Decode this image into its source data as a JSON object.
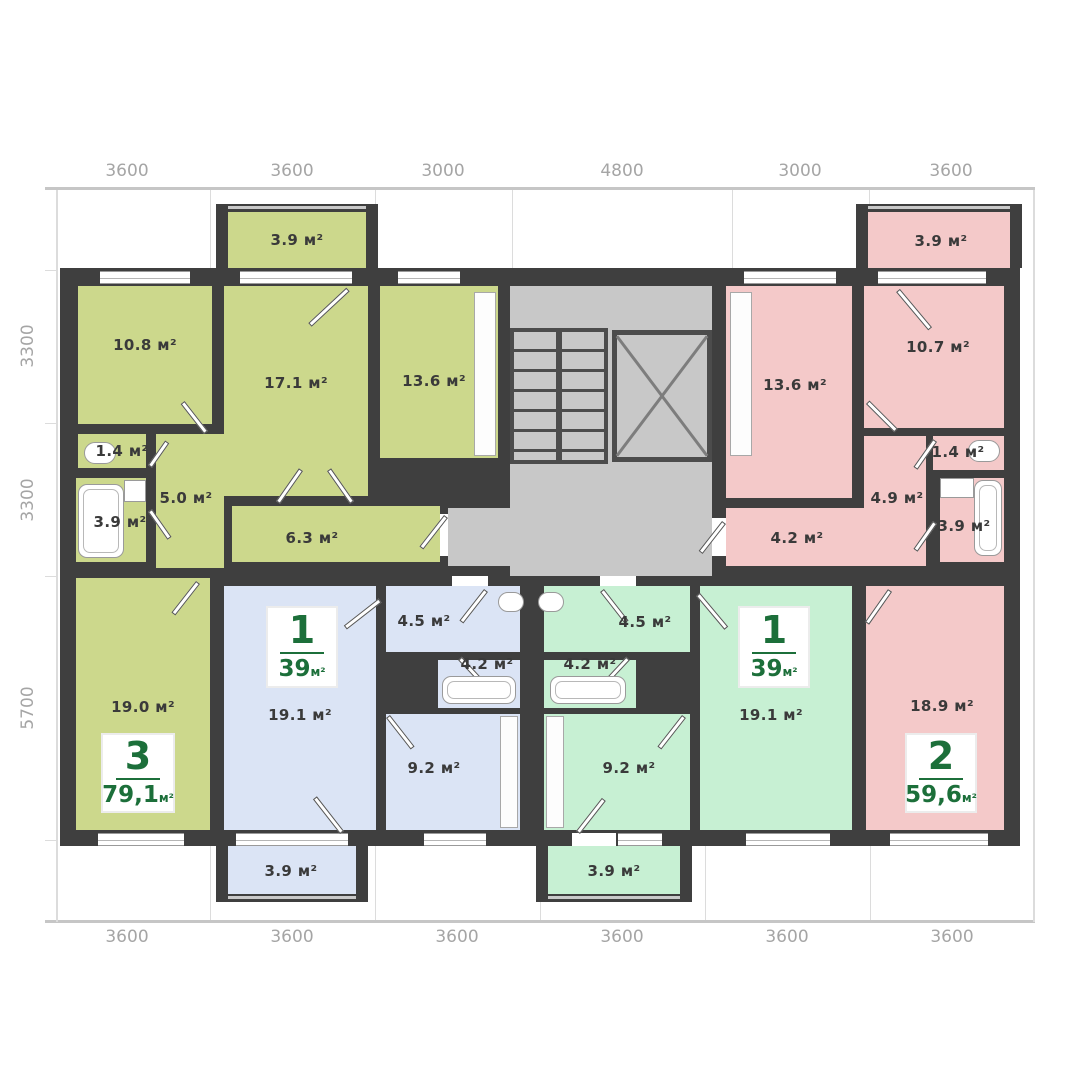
{
  "plan": {
    "title": "apartment-floor-plan",
    "dims": {
      "top": [
        "3600",
        "3600",
        "3000",
        "4800",
        "3000",
        "3600"
      ],
      "left": [
        "3300",
        "3300",
        "5700"
      ],
      "bottom": [
        "3600",
        "3600",
        "3600",
        "3600",
        "3600",
        "3600"
      ]
    },
    "apartments": {
      "apt3": {
        "number": "3",
        "area": "79,1",
        "unit": "м²",
        "rooms": {
          "balcony": "3.9 м²",
          "bedroom": "10.8 м²",
          "living": "17.1 м²",
          "kitchen": "13.6 м²",
          "wc": "1.4 м²",
          "bath": "3.9 м²",
          "hall": "5.0 м²",
          "corridor": "6.3 м²",
          "bedroom2": "19.0 м²"
        }
      },
      "apt1a": {
        "number": "1",
        "area": "39",
        "unit": "м²",
        "rooms": {
          "living": "19.1 м²",
          "hall": "4.5 м²",
          "bath": "4.2 м²",
          "kitchen": "9.2 м²",
          "balcony": "3.9 м²"
        }
      },
      "apt1b": {
        "number": "1",
        "area": "39",
        "unit": "м²",
        "rooms": {
          "living": "19.1 м²",
          "hall": "4.5 м²",
          "bath": "4.2 м²",
          "kitchen": "9.2 м²",
          "balcony": "3.9 м²"
        }
      },
      "apt2": {
        "number": "2",
        "area": "59,6",
        "unit": "м²",
        "rooms": {
          "balcony": "3.9 м²",
          "kitchen": "13.6 м²",
          "bedroom": "10.7 м²",
          "wc": "1.4 м²",
          "hall": "4.9 м²",
          "bath": "3.9 м²",
          "corridor": "4.2 м²",
          "living": "18.9 м²"
        }
      }
    },
    "colors": {
      "apt3_fill": "#ccd88c",
      "apt1a_fill": "#dbe4f5",
      "apt1b_fill": "#c7f0d3",
      "apt2_fill": "#f4c9c9",
      "common_fill": "#c8c8c8",
      "wall": "#3f3f3f",
      "badge_green": "#1c6f3a",
      "dimension_text": "#a5a5a5"
    }
  }
}
